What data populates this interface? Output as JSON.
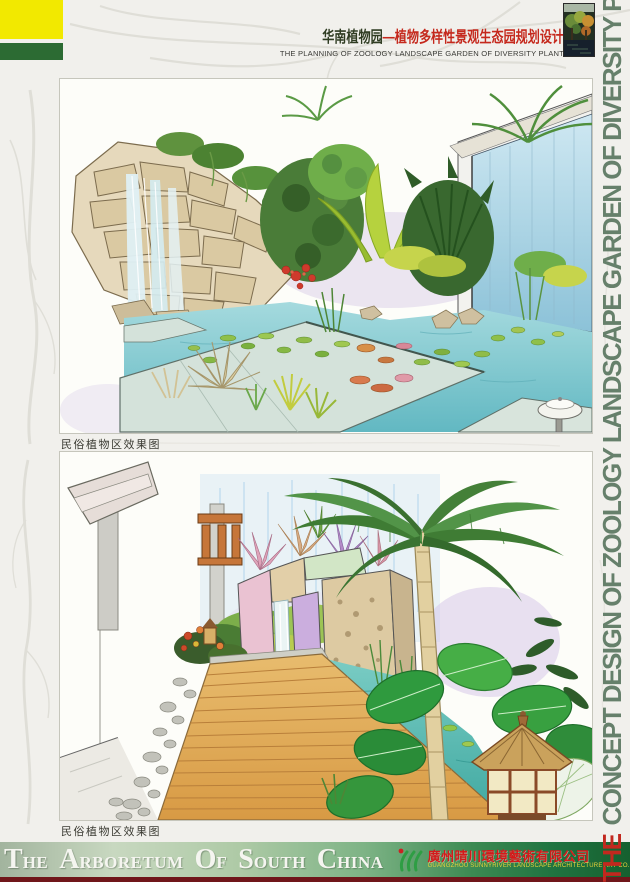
{
  "header": {
    "title_prefix": "华南植物园",
    "title_main": "—植物多样性景观生态园规划设计",
    "subtitle": "THE PLANNING OF ZOOLOGY LANDSCAPE GARDEN OF DIVERSITY PLANT"
  },
  "side_title": {
    "the": "THE",
    "rest": "CONCEPT DESIGN OF ZOOLOGY LANDSCAPE GARDEN OF DIVERSITY PLANT"
  },
  "figures": [
    {
      "caption": "民俗植物区效果图"
    },
    {
      "caption": "民俗植物区效果图"
    }
  ],
  "footer": {
    "words": [
      [
        "T",
        "HE"
      ],
      [
        "A",
        "RBORETUM"
      ],
      [
        "O",
        "F"
      ],
      [
        "S",
        "OUTH"
      ],
      [
        "C",
        "HINA"
      ]
    ],
    "company_zh": "廣州晴川環境藝術有限公司",
    "company_en": "GUANGZHOU SUNNYRIVER LANDSCAPE ARCHITECTURE ART CO.LTD"
  },
  "colors": {
    "corner_yellow": "#f2e900",
    "corner_green": "#2c6b33",
    "title_red": "#c5281c",
    "title_dark": "#2f3c22",
    "side_title_green": "#66806b",
    "side_title_red": "#c2281e",
    "banner_gradient_left": "#a2b49e",
    "banner_gradient_right": "#16602f",
    "banner_text": "#f5f5f0",
    "company_red": "#d41a1a",
    "company_en_yellow": "#e6d23a",
    "footer_red_strip": "#70161a"
  }
}
